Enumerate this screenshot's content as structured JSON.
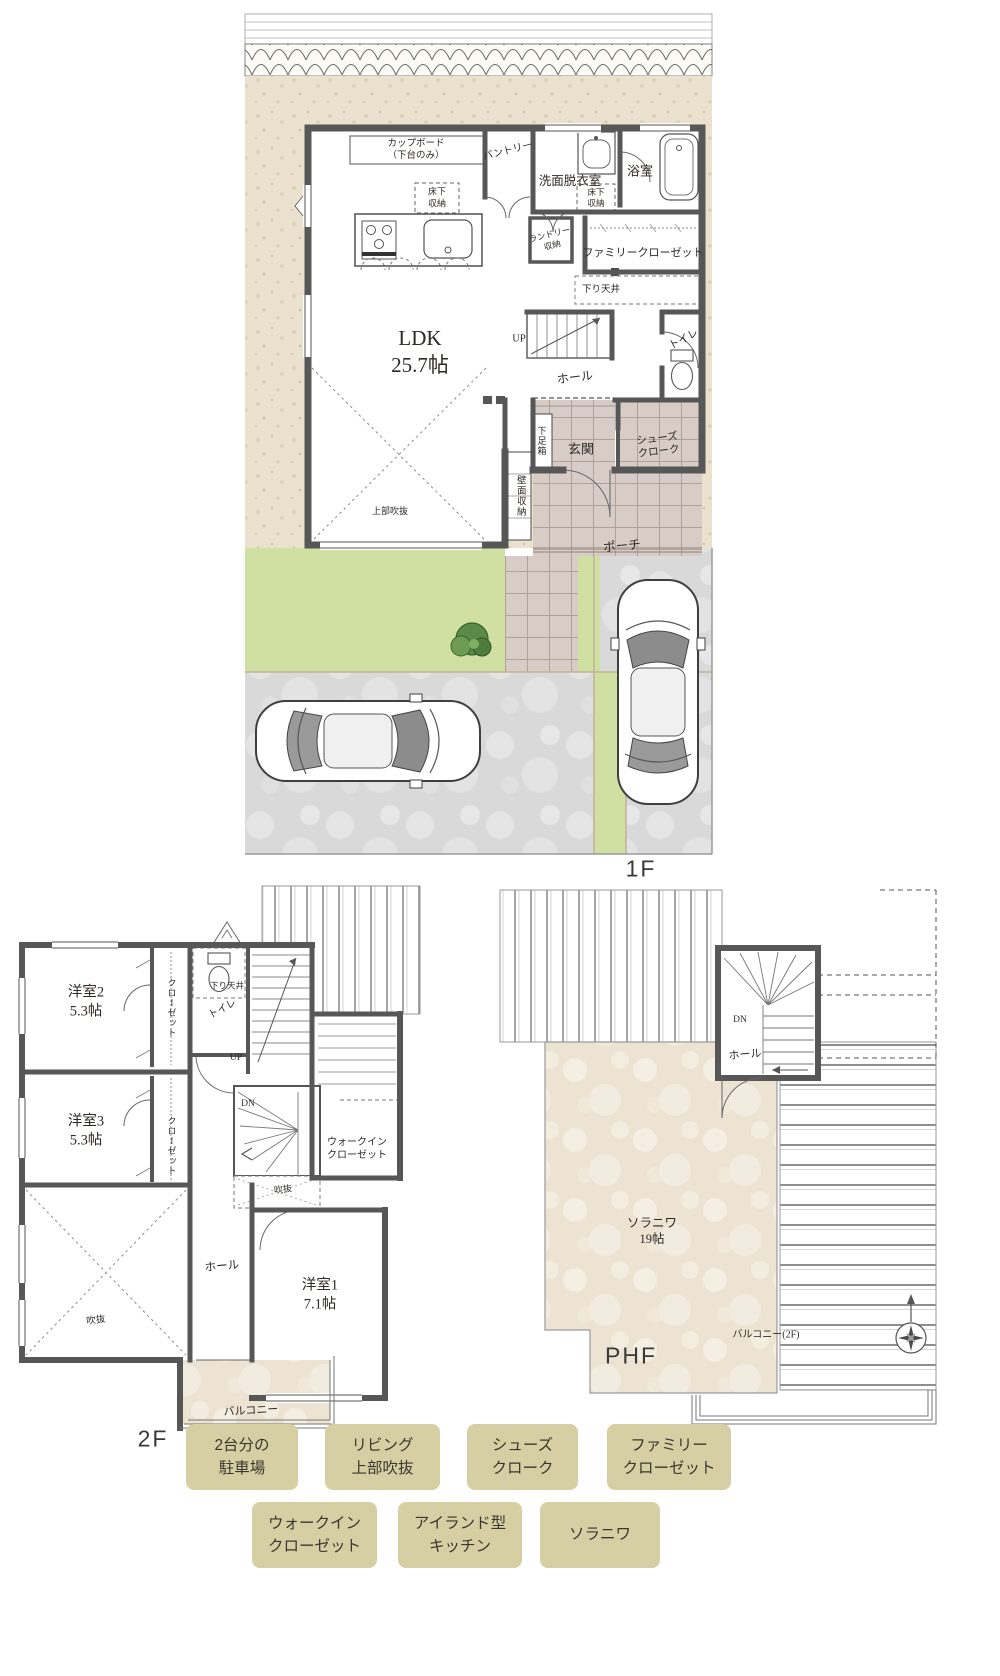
{
  "floor1": {
    "label": "1F",
    "rooms": {
      "cupboard": "カップボード\n（下台のみ）",
      "pantry": "パントリー",
      "washroom": "洗面脱衣室",
      "bathroom": "浴室",
      "underfloor_storage_kitchen": "床下\n収納",
      "underfloor_storage_washroom": "床下\n収納",
      "laundry_storage": "ランドリー\n収納",
      "family_closet": "ファミリークローゼット",
      "lowered_ceiling": "下り天井",
      "ldk": "LDK\n25.7帖",
      "up": "UP",
      "hall": "ホール",
      "toilet": "トイレ",
      "shoe_box": "下足箱",
      "entrance": "玄関",
      "shoes_cloak": "シューズ\nクローク",
      "wall_storage": "壁面収納",
      "upper_void": "上部吹抜",
      "porch": "ポーチ"
    }
  },
  "floor2": {
    "label": "2F",
    "rooms": {
      "room2": "洋室2\n5.3帖",
      "closet_a": "クローゼット",
      "lowered_ceiling": "下り天井",
      "toilet": "トイレ",
      "up": "UP",
      "dn": "DN",
      "room3": "洋室3\n5.3帖",
      "closet_b": "クローゼット",
      "walk_in_closet": "ウォークイン\nクローゼット",
      "void_stairwell": "吹抜",
      "hall": "ホール",
      "room1": "洋室1\n7.1帖",
      "void_living": "吹抜",
      "balcony": "バルコニー"
    }
  },
  "phf": {
    "label": "PHF",
    "rooms": {
      "dn": "DN",
      "hall": "ホール",
      "solaniwa": "ソラニワ\n19帖",
      "balcony_2f": "バルコニー(2F)"
    }
  },
  "feature_tags": [
    "2台分の\n駐車場",
    "リビング\n上部吹抜",
    "シューズ\nクローク",
    "ファミリー\nクローゼット",
    "ウォークイン\nクローゼット",
    "アイランド型\nキッチン",
    "ソラニワ"
  ],
  "colors": {
    "wall": "#575757",
    "site_stone": "#eae2cf",
    "tile": "#d7cdc6",
    "lawn": "#cfe0a2",
    "concrete": "#d9d9d9",
    "deck_beige": "#ece3d2",
    "tag_bg": "#d5cfa3",
    "text": "#2e2a26"
  }
}
